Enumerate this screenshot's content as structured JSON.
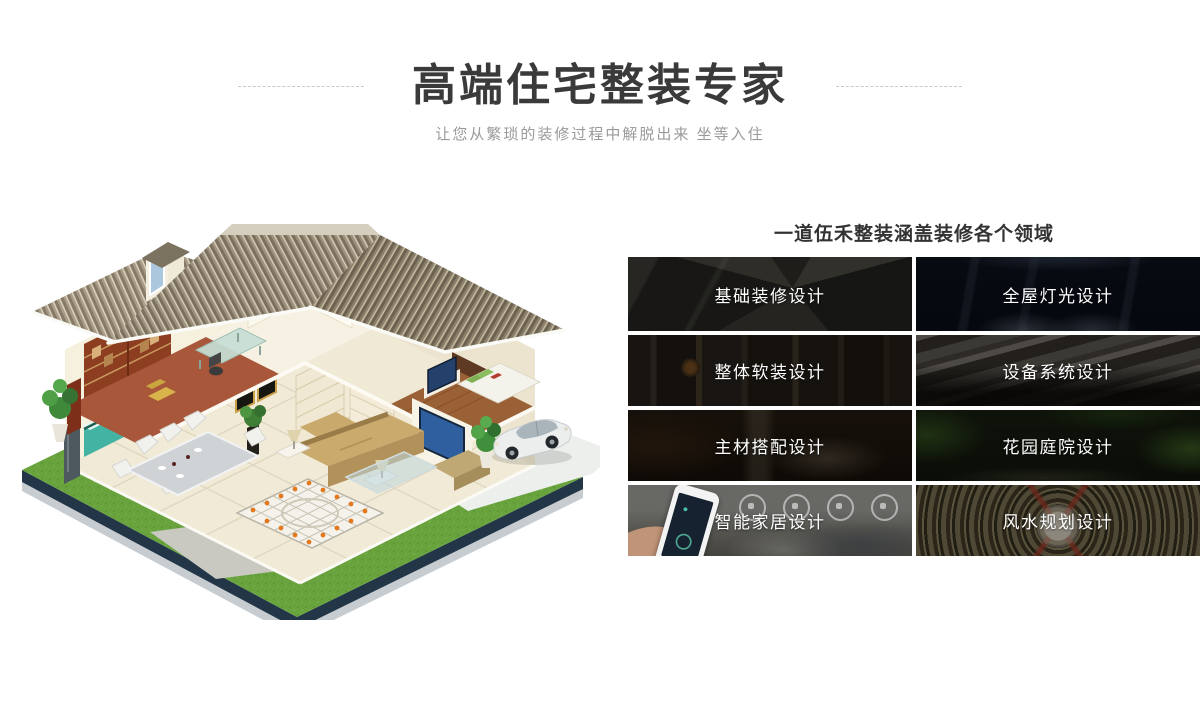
{
  "header": {
    "title": "高端住宅整装专家",
    "subtitle": "让您从繁琐的装修过程中解脱出来 坐等入住"
  },
  "services": {
    "heading": "一道伍禾整装涵盖装修各个领域",
    "tiles": [
      {
        "label": "基础装修设计",
        "image": "interior-3d-floorplan-photo"
      },
      {
        "label": "全屋灯光设计",
        "image": "home-theater-lighting-photo"
      },
      {
        "label": "整体软装设计",
        "image": "soft-furnishing-interior-photo"
      },
      {
        "label": "设备系统设计",
        "image": "hvac-equipment-pipes-photo"
      },
      {
        "label": "主材搭配设计",
        "image": "bathroom-materials-photo"
      },
      {
        "label": "花园庭院设计",
        "image": "garden-courtyard-photo"
      },
      {
        "label": "智能家居设计",
        "image": "smartphone-smart-home-photo"
      },
      {
        "label": "风水规划设计",
        "image": "fengshui-compass-photo"
      }
    ]
  },
  "illustration": {
    "description": "isometric cutaway house with furnished interior, lawn, driveway and car"
  },
  "colors": {
    "title_text": "#3a3a3a",
    "subtitle_text": "#9a9a9a",
    "heading_text": "#333333",
    "tile_label": "#ffffff",
    "divider_dash": "#c9c9c9"
  }
}
